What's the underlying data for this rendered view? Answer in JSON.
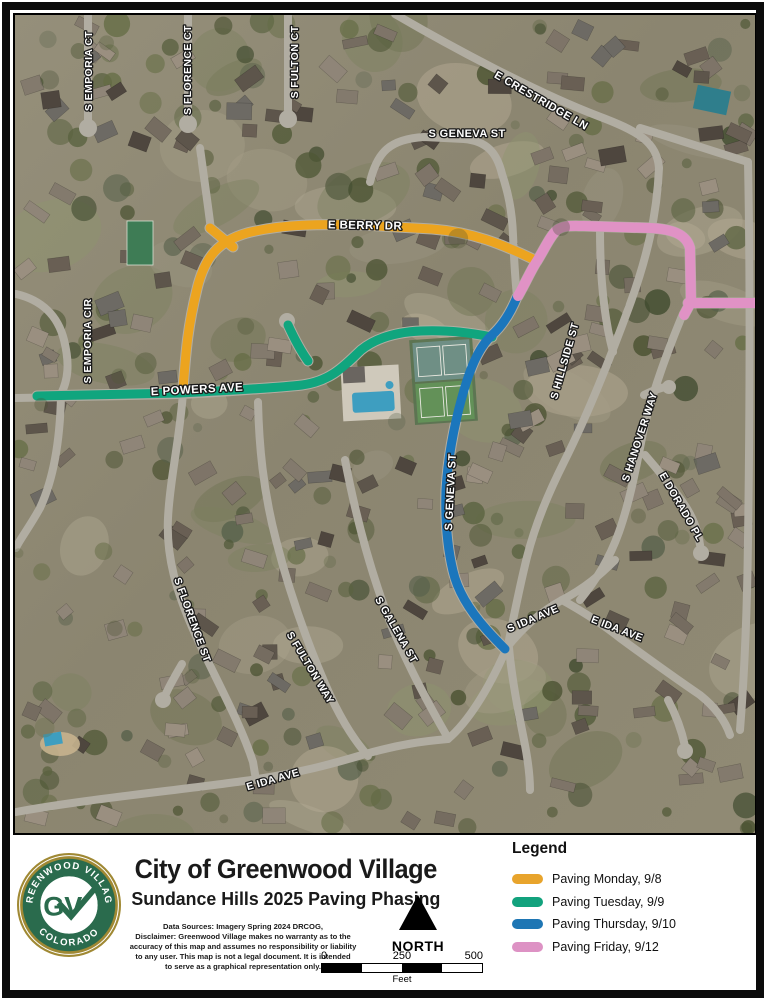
{
  "title_block": {
    "title": "City of Greenwood Village",
    "subtitle": "Sundance Hills 2025 Paving Phasing",
    "disclaimer_lines": [
      "Data Sources: Imagery Spring 2024 DRCOG,",
      "Disclaimer: Greenwood Village makes no warranty as to the",
      "accuracy of this map and assumes no responsibility or liability",
      "to any user. This map is not a legal document. It is intended",
      "to serve as a graphical representation only."
    ]
  },
  "logo": {
    "arc_top": "GREENWOOD VILLAGE",
    "arc_bottom": "COLORADO",
    "monogram": "GV",
    "green": "#2a6b4d",
    "gold": "#a08934"
  },
  "north_arrow": {
    "label": "NORTH"
  },
  "scale_bar": {
    "ticks": [
      "0",
      "250",
      "500"
    ],
    "unit": "Feet"
  },
  "legend": {
    "heading": "Legend",
    "items": [
      {
        "id": "monday",
        "label": "Paving Monday, 9/8",
        "color": "#E8A42C"
      },
      {
        "id": "tuesday",
        "label": "Paving Tuesday, 9/9",
        "color": "#12A27D"
      },
      {
        "id": "thursday",
        "label": "Paving Thursday, 9/10",
        "color": "#1E76B4"
      },
      {
        "id": "friday",
        "label": "Paving Friday, 9/12",
        "color": "#DD92C4"
      }
    ]
  },
  "map": {
    "street_labels": [
      {
        "text": "S EMPORIA CT",
        "x": 89,
        "y": 71,
        "angle": -90,
        "size": 10.5
      },
      {
        "text": "S FLORENCE CT",
        "x": 188,
        "y": 70,
        "angle": -90,
        "size": 10.5
      },
      {
        "text": "S FULTON CT",
        "x": 295,
        "y": 62,
        "angle": -90,
        "size": 10.5
      },
      {
        "text": "S GENEVA ST",
        "x": 467,
        "y": 134,
        "angle": 0,
        "size": 11
      },
      {
        "text": "E CRESTRIDGE LN",
        "x": 541,
        "y": 101,
        "angle": 30,
        "size": 11
      },
      {
        "text": "E BERRY DR",
        "x": 365,
        "y": 226,
        "angle": 1,
        "size": 11.5
      },
      {
        "text": "S EMPORIA CIR",
        "x": 88,
        "y": 341,
        "angle": -90,
        "size": 10.5
      },
      {
        "text": "E POWERS AVE",
        "x": 197,
        "y": 390,
        "angle": -3,
        "size": 11.5
      },
      {
        "text": "S GENEVA ST",
        "x": 451,
        "y": 492,
        "angle": -87,
        "size": 11
      },
      {
        "text": "S HILLSIDE ST",
        "x": 565,
        "y": 361,
        "angle": -74,
        "size": 10.5
      },
      {
        "text": "S HANOVER WAY",
        "x": 640,
        "y": 437,
        "angle": -72,
        "size": 10.5
      },
      {
        "text": "E DORADO PL",
        "x": 681,
        "y": 507,
        "angle": 60,
        "size": 10.5
      },
      {
        "text": "S FLORENCE ST",
        "x": 192,
        "y": 620,
        "angle": 70,
        "size": 10.5
      },
      {
        "text": "S FULTON WAY",
        "x": 310,
        "y": 668,
        "angle": 59,
        "size": 10.5
      },
      {
        "text": "S GALENA ST",
        "x": 396,
        "y": 630,
        "angle": 60,
        "size": 10.5
      },
      {
        "text": "E IDA AVE",
        "x": 273,
        "y": 780,
        "angle": -16,
        "size": 10.5
      },
      {
        "text": "S IDA AVE",
        "x": 533,
        "y": 619,
        "angle": -23,
        "size": 10.5
      },
      {
        "text": "E IDA AVE",
        "x": 617,
        "y": 629,
        "angle": 21,
        "size": 10.5
      }
    ],
    "routes": [
      {
        "id": "paving-monday",
        "color": "#ECA41F",
        "width": 9,
        "paths": [
          "M 183,389 C 186,349 188,326 197,289 C 205,256 219,241 247,233 C 282,224 322,224 362,225 L 432,229 C 472,232 502,244 537,261",
          "M 210,228 L 233,247"
        ]
      },
      {
        "id": "paving-tuesday",
        "color": "#10A57E",
        "width": 9,
        "paths": [
          "M 37,396 L 180,393 C 240,390 275,388 302,385 C 332,381 346,364 361,350 C 376,338 396,332 421,331 C 451,330 471,333 492,337",
          "M 288,325 C 294,338 300,350 308,361"
        ]
      },
      {
        "id": "paving-thursday",
        "color": "#1B76BC",
        "width": 9,
        "paths": [
          "M 517,297 C 510,314 502,326 492,335 C 477,349 469,372 462,397 C 454,426 448,456 446,490 C 445,520 447,546 453,571 C 458,593 471,612 486,629 C 493,637 499,643 505,649"
        ]
      },
      {
        "id": "paving-friday",
        "color": "#E092C5",
        "width": 10,
        "paths": [
          "M 518,296 C 526,282 531,270 537,261 C 544,250 550,236 557,230 C 564,225 572,226 584,226 L 650,228 C 670,229 686,233 690,248 L 691,302",
          "M 688,303 L 761,303",
          "M 691,302 L 684,315"
        ]
      }
    ]
  }
}
